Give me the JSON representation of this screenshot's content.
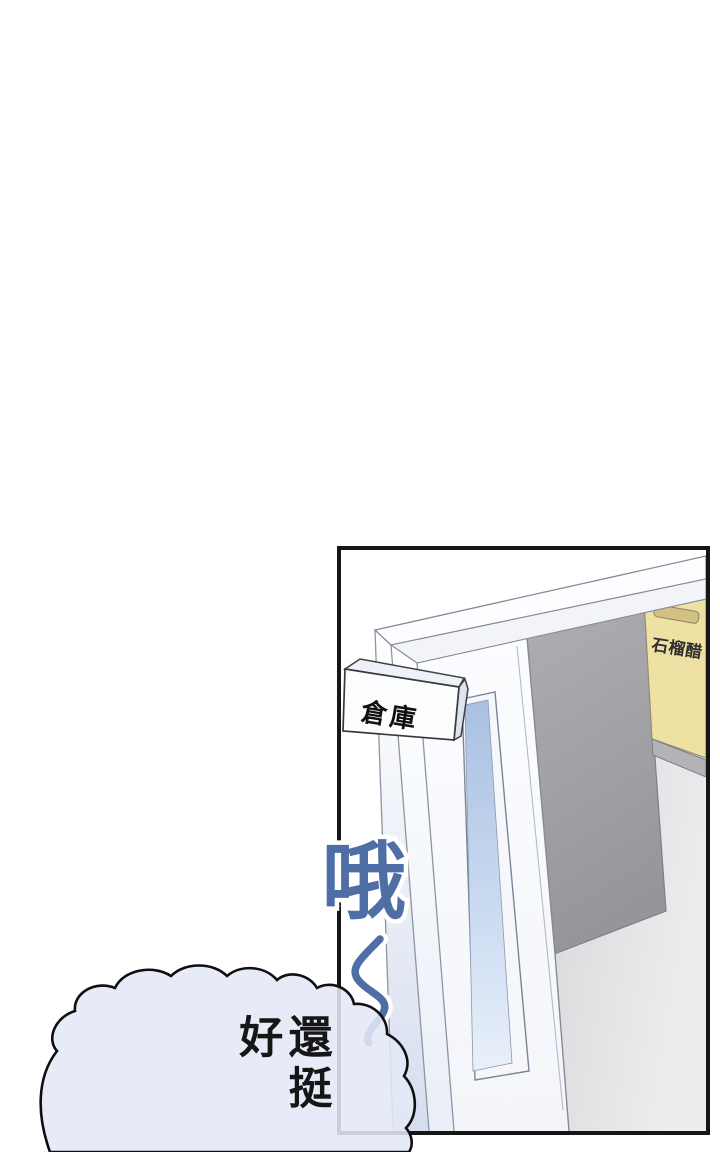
{
  "comic_page": {
    "background_color": "#ffffff",
    "panel": {
      "border_color": "#161616",
      "door_sign_label": "倉庫",
      "box_label": "石榴醋",
      "colors": {
        "door_white": "#fcfdff",
        "window_blue": "#aac1e3",
        "interior_wall_gray": "#d8d8db",
        "doorway_shadow_gray": "#a2a2a6",
        "box_yellow": "#efe1a4",
        "shelf_gray": "#b4b4b8"
      }
    },
    "sfx": {
      "char": "哦",
      "wave": "～",
      "color": "#506ea6"
    },
    "speech_bubble": {
      "text": "還挺好",
      "fill_color": "#e4e8f6",
      "outline_color": "#0f0f0f",
      "text_color": "#161616"
    }
  }
}
